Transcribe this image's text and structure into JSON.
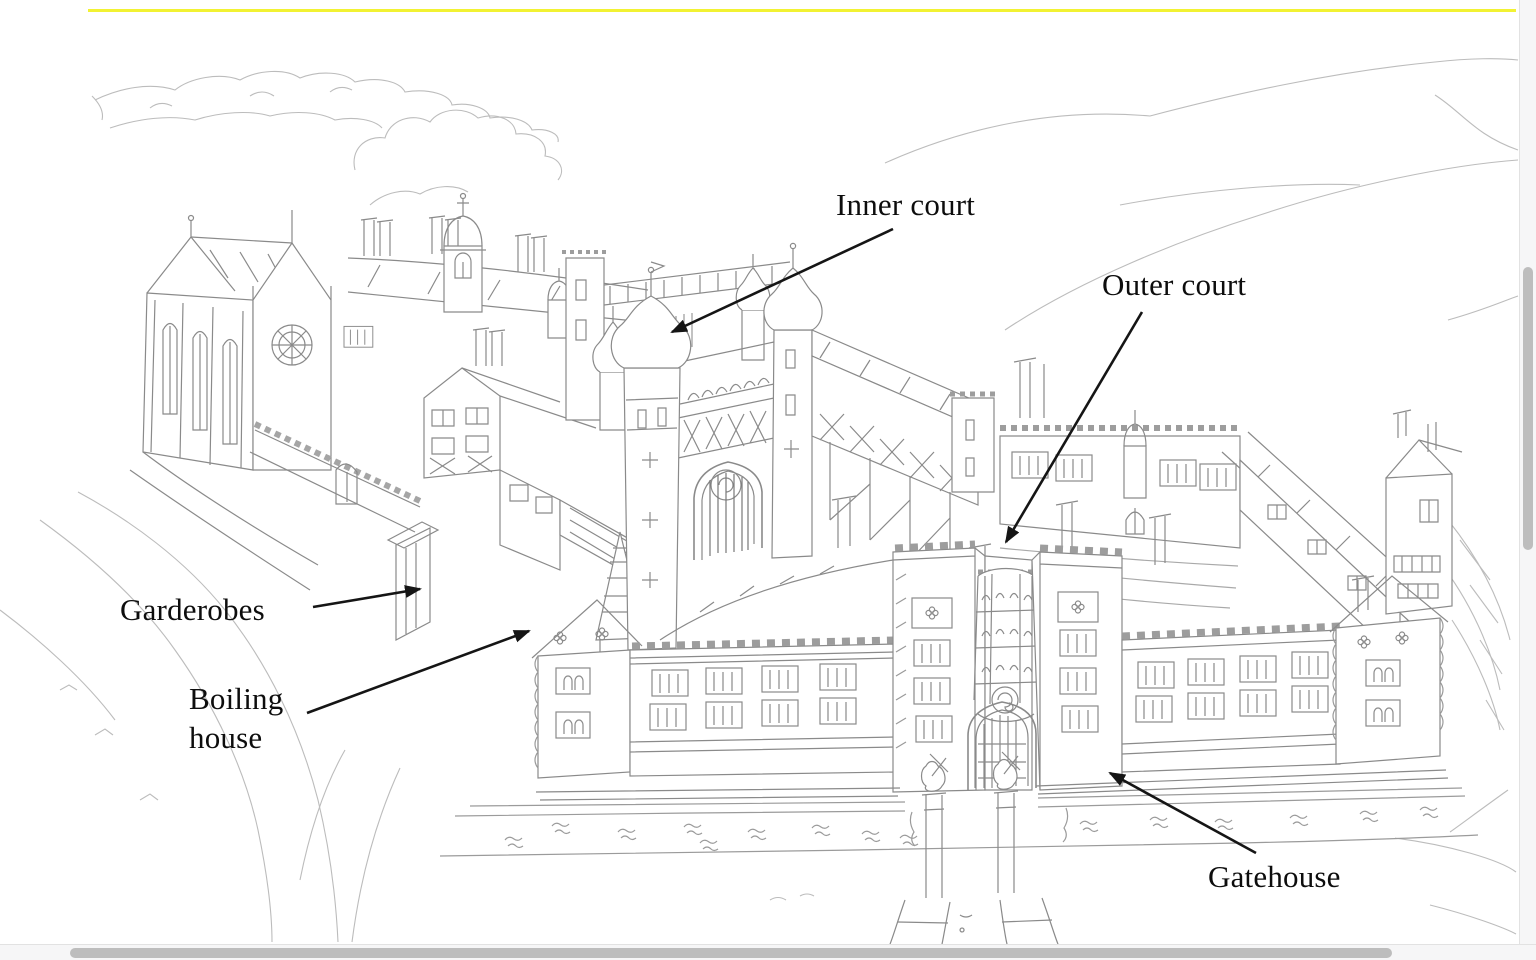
{
  "figure": {
    "type": "labeled-illustration",
    "subject": "Aerial pencil drawing of a Tudor palace complex with moat and courtyards",
    "annotations": [
      {
        "id": "inner-court",
        "label": "Inner court"
      },
      {
        "id": "outer-court",
        "label": "Outer court"
      },
      {
        "id": "garderobes",
        "label": "Garderobes"
      },
      {
        "id": "boiling-house",
        "label": "Boiling house"
      },
      {
        "id": "gatehouse",
        "label": "Gatehouse"
      }
    ]
  },
  "colors": {
    "highlight_line": "#f2f233",
    "pencil_stroke": "#8a8a8a",
    "annotation_ink": "#151515",
    "scrollbar_thumb": "#bdbdbd",
    "scrollbar_track": "#f6f6f7"
  },
  "scrollbars": {
    "horizontal_visible": true,
    "vertical_visible": true
  }
}
